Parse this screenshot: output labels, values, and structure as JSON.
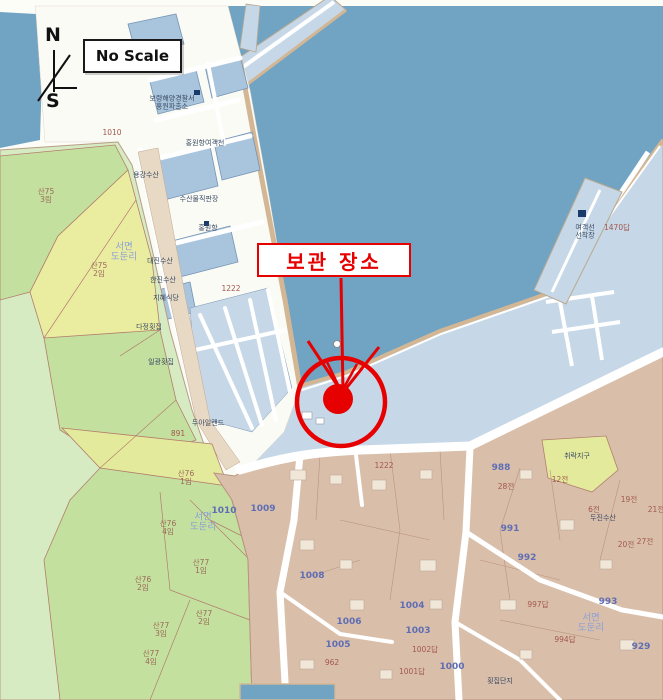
{
  "scale_box": {
    "label": "No Scale"
  },
  "compass": {
    "north": "N",
    "south": "S"
  },
  "annotation": {
    "label": "보관 장소",
    "color": "#e60000"
  },
  "map": {
    "colors": {
      "sea": "#71a3c3",
      "quay_pavement": "#c6d7e7",
      "port_lot": "#a9c5dd",
      "quay_edge": "#d3b795",
      "village_land": "#d9bfaa",
      "building": "#f0e7d8",
      "forest_green": "#c4e09e",
      "coast_green": "#d7ebc3",
      "field_yellow": "#eaeda0",
      "road": "#ffffff",
      "marker_red": "#e60000"
    },
    "labels": [
      {
        "text": "서면\n도둔리",
        "x": 124,
        "y": 253,
        "c": "district"
      },
      {
        "text": "서면\n도둔리",
        "x": 203,
        "y": 523,
        "c": "district"
      },
      {
        "text": "서면\n도둔리",
        "x": 591,
        "y": 624,
        "c": "district"
      },
      {
        "text": "1010",
        "x": 224,
        "y": 512,
        "c": "num-blue"
      },
      {
        "text": "1008",
        "x": 312,
        "y": 577,
        "c": "num-blue"
      },
      {
        "text": "1009",
        "x": 263,
        "y": 510,
        "c": "num-blue"
      },
      {
        "text": "988",
        "x": 501,
        "y": 469,
        "c": "num-blue"
      },
      {
        "text": "991",
        "x": 510,
        "y": 530,
        "c": "num-blue"
      },
      {
        "text": "992",
        "x": 527,
        "y": 559,
        "c": "num-blue"
      },
      {
        "text": "993",
        "x": 608,
        "y": 603,
        "c": "num-blue"
      },
      {
        "text": "929",
        "x": 641,
        "y": 648,
        "c": "num-blue"
      },
      {
        "text": "1000",
        "x": 452,
        "y": 668,
        "c": "num-blue"
      },
      {
        "text": "1003",
        "x": 418,
        "y": 632,
        "c": "num-blue"
      },
      {
        "text": "1004",
        "x": 412,
        "y": 607,
        "c": "num-blue"
      },
      {
        "text": "1005",
        "x": 338,
        "y": 646,
        "c": "num-blue"
      },
      {
        "text": "1006",
        "x": 349,
        "y": 623,
        "c": "num-blue"
      },
      {
        "text": "1222",
        "x": 231,
        "y": 289,
        "c": "num-red"
      },
      {
        "text": "1222",
        "x": 384,
        "y": 466,
        "c": "num-red"
      },
      {
        "text": "1010",
        "x": 112,
        "y": 133,
        "c": "num-red"
      },
      {
        "text": "1470답",
        "x": 617,
        "y": 228,
        "c": "num-red"
      },
      {
        "text": "997답",
        "x": 538,
        "y": 605,
        "c": "num-red"
      },
      {
        "text": "994답",
        "x": 565,
        "y": 640,
        "c": "num-red"
      },
      {
        "text": "1002답",
        "x": 425,
        "y": 650,
        "c": "num-red"
      },
      {
        "text": "1001답",
        "x": 412,
        "y": 672,
        "c": "num-red"
      },
      {
        "text": "891",
        "x": 178,
        "y": 434,
        "c": "num-red"
      },
      {
        "text": "962",
        "x": 332,
        "y": 663,
        "c": "num-red"
      },
      {
        "text": "28전",
        "x": 506,
        "y": 487,
        "c": "num-red"
      },
      {
        "text": "12전",
        "x": 560,
        "y": 480,
        "c": "num-red"
      },
      {
        "text": "6전",
        "x": 594,
        "y": 510,
        "c": "num-red"
      },
      {
        "text": "19전",
        "x": 629,
        "y": 500,
        "c": "num-red"
      },
      {
        "text": "21전",
        "x": 656,
        "y": 510,
        "c": "num-red"
      },
      {
        "text": "20전",
        "x": 626,
        "y": 545,
        "c": "num-red"
      },
      {
        "text": "27전",
        "x": 645,
        "y": 542,
        "c": "num-red"
      },
      {
        "text": "산75\n3림",
        "x": 46,
        "y": 196,
        "c": "mtn"
      },
      {
        "text": "산75\n2임",
        "x": 99,
        "y": 270,
        "c": "mtn"
      },
      {
        "text": "산76\n1임",
        "x": 186,
        "y": 478,
        "c": "mtn"
      },
      {
        "text": "산76\n4임",
        "x": 168,
        "y": 528,
        "c": "mtn"
      },
      {
        "text": "산76\n2임",
        "x": 143,
        "y": 584,
        "c": "mtn"
      },
      {
        "text": "산77\n1임",
        "x": 201,
        "y": 567,
        "c": "mtn"
      },
      {
        "text": "산77\n2임",
        "x": 204,
        "y": 618,
        "c": "mtn"
      },
      {
        "text": "산77\n3임",
        "x": 161,
        "y": 630,
        "c": "mtn"
      },
      {
        "text": "산77\n4임",
        "x": 151,
        "y": 658,
        "c": "mtn"
      },
      {
        "text": "보령해양경찰서\n홍원파출소",
        "x": 172,
        "y": 103,
        "c": "poi"
      },
      {
        "text": "홍원항여객선",
        "x": 205,
        "y": 144,
        "c": "poi"
      },
      {
        "text": "수산물직판장",
        "x": 199,
        "y": 200,
        "c": "poi"
      },
      {
        "text": "용강수산",
        "x": 146,
        "y": 176,
        "c": "poi"
      },
      {
        "text": "대진수산",
        "x": 160,
        "y": 262,
        "c": "poi"
      },
      {
        "text": "한진수산",
        "x": 163,
        "y": 281,
        "c": "poi"
      },
      {
        "text": "지혜식당",
        "x": 166,
        "y": 299,
        "c": "poi"
      },
      {
        "text": "다정횟집",
        "x": 149,
        "y": 328,
        "c": "poi"
      },
      {
        "text": "일광횟집",
        "x": 161,
        "y": 363,
        "c": "poi"
      },
      {
        "text": "두아일랜드",
        "x": 208,
        "y": 424,
        "c": "poi"
      },
      {
        "text": "홍원항",
        "x": 208,
        "y": 229,
        "c": "poi"
      },
      {
        "text": "여객선\n선착장",
        "x": 585,
        "y": 232,
        "c": "poi"
      },
      {
        "text": "두진수산",
        "x": 603,
        "y": 519,
        "c": "poi"
      },
      {
        "text": "취락지구",
        "x": 577,
        "y": 457,
        "c": "poi"
      },
      {
        "text": "횟집단지",
        "x": 500,
        "y": 682,
        "c": "poi"
      }
    ]
  }
}
